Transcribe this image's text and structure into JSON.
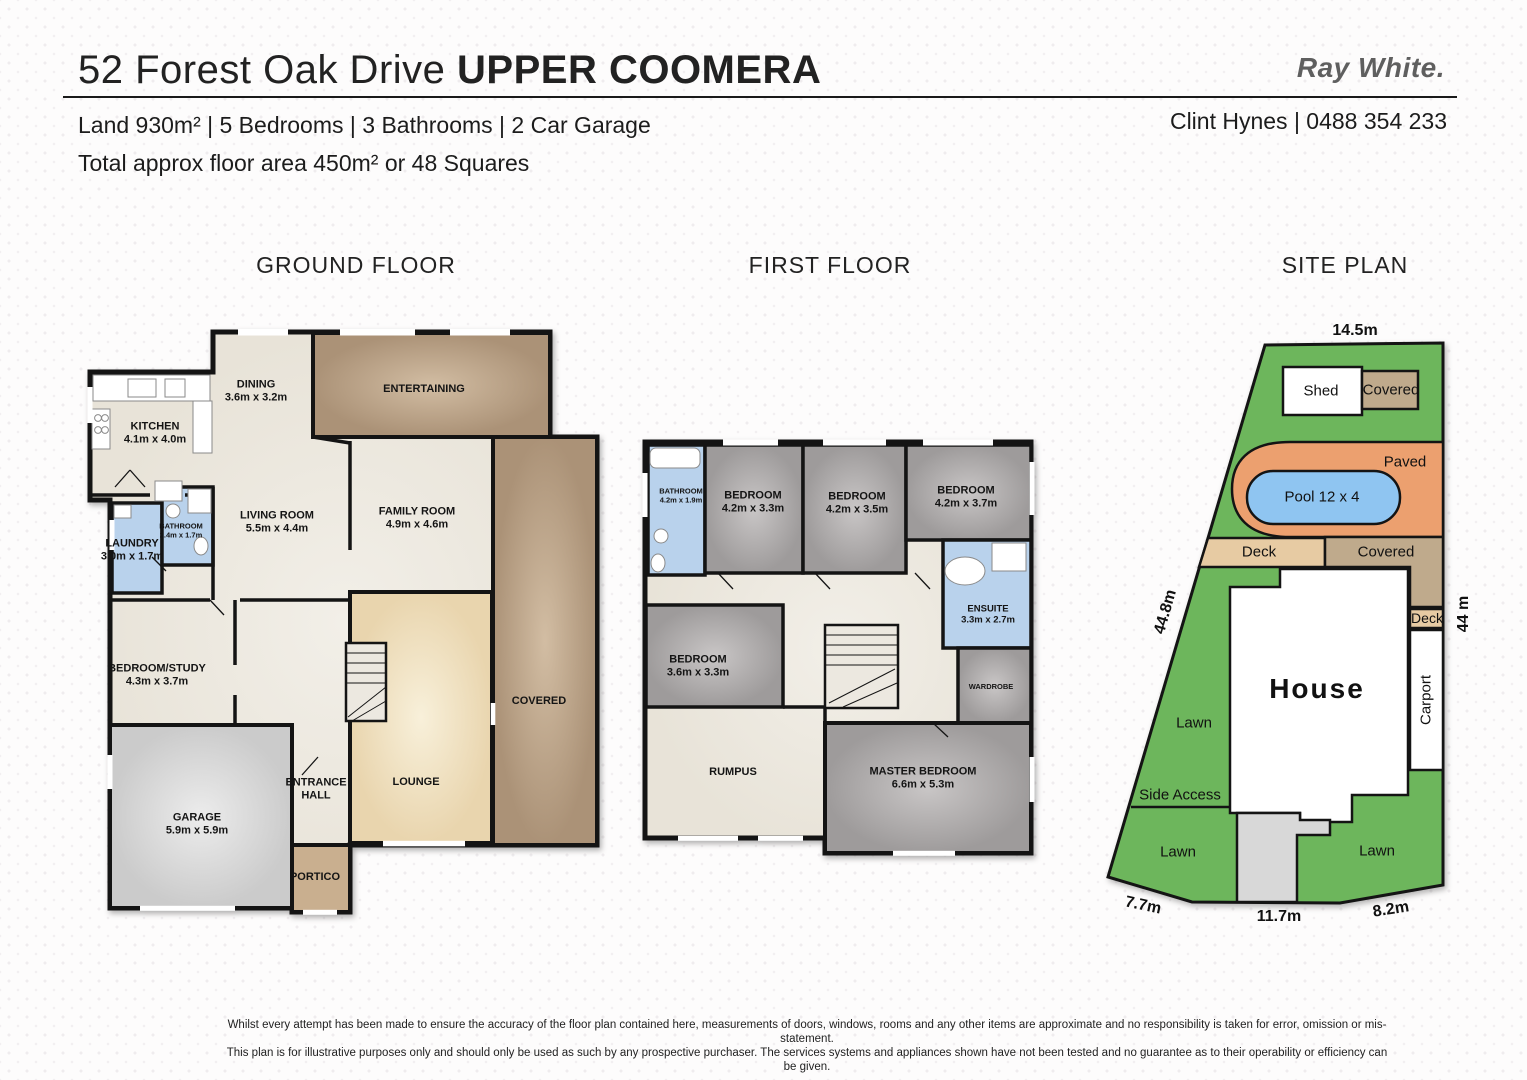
{
  "header": {
    "address": "52 Forest Oak Drive",
    "suburb": "UPPER COOMERA",
    "brand": "Ray White.",
    "agent": "Clint Hynes | 0488 354 233",
    "land_line": "Land 930m² | 5 Bedrooms | 3 Bathrooms | 2 Car Garage",
    "area_line": "Total approx floor area 450m² or 48 Squares"
  },
  "sections": {
    "ground": "GROUND FLOOR",
    "first": "FIRST FLOOR",
    "site": "SITE PLAN"
  },
  "ground_floor": {
    "rooms": {
      "kitchen": {
        "name": "KITCHEN",
        "dims": "4.1m x 4.0m"
      },
      "dining": {
        "name": "DINING",
        "dims": "3.6m x 3.2m"
      },
      "entertaining": {
        "name": "ENTERTAINING",
        "dims": ""
      },
      "living": {
        "name": "LIVING ROOM",
        "dims": "5.5m x 4.4m"
      },
      "family": {
        "name": "FAMILY ROOM",
        "dims": "4.9m x 4.6m"
      },
      "bathroom": {
        "name": "BATHROOM",
        "dims": "2.4m x 1.7m"
      },
      "laundry": {
        "name": "LAUNDRY",
        "dims": "3.0m x 1.7m"
      },
      "bedroom_study": {
        "name": "BEDROOM/STUDY",
        "dims": "4.3m x 3.7m"
      },
      "entrance_hall": {
        "name": "ENTRANCE HALL",
        "dims": ""
      },
      "lounge": {
        "name": "LOUNGE",
        "dims": ""
      },
      "covered": {
        "name": "COVERED",
        "dims": ""
      },
      "garage": {
        "name": "GARAGE",
        "dims": "5.9m x 5.9m"
      },
      "portico": {
        "name": "PORTICO",
        "dims": ""
      }
    }
  },
  "first_floor": {
    "rooms": {
      "bathroom": {
        "name": "BATHROOM",
        "dims": "4.2m x 1.9m"
      },
      "bedroom_1": {
        "name": "BEDROOM",
        "dims": "4.2m x 3.3m"
      },
      "bedroom_2": {
        "name": "BEDROOM",
        "dims": "4.2m x 3.5m"
      },
      "bedroom_3": {
        "name": "BEDROOM",
        "dims": "4.2m x 3.7m"
      },
      "bedroom_4": {
        "name": "BEDROOM",
        "dims": "3.6m x 3.3m"
      },
      "ensuite": {
        "name": "ENSUITE",
        "dims": "3.3m x 2.7m"
      },
      "wardrobe": {
        "name": "WARDROBE",
        "dims": ""
      },
      "rumpus": {
        "name": "RUMPUS",
        "dims": ""
      },
      "master_bedroom": {
        "name": "MASTER BEDROOM",
        "dims": "6.6m x 5.3m"
      }
    }
  },
  "site_plan": {
    "labels": {
      "shed": "Shed",
      "covered_top": "Covered",
      "paved": "Paved",
      "pool": "Pool 12 x 4",
      "deck": "Deck",
      "covered_mid": "Covered",
      "deck_small": "Deck",
      "carport": "Carport",
      "house": "House",
      "lawn_left": "Lawn",
      "side_access": "Side Access",
      "lawn_bottom_left": "Lawn",
      "lawn_bottom_right": "Lawn"
    },
    "dimensions": {
      "top": "14.5m",
      "left": "44.8m",
      "right": "44 m",
      "bottom_left": "7.7m",
      "bottom_center": "11.7m",
      "bottom_right": "8.2m"
    }
  },
  "disclaimer": {
    "line1": "Whilst every attempt has been made to ensure the accuracy of the floor plan contained here, measurements of doors, windows, rooms and any other items are approximate and no responsibility is taken for error, omission or mis-statement.",
    "line2": "This plan is for illustrative purposes only and should only be used as such by any prospective purchaser. The services systems and appliances shown have not been tested and no guarantee as to their operability or efficiency can be given."
  },
  "colors": {
    "wall": "#141414",
    "floor_cream": "#ece8e0",
    "wet_area_blue": "#b9d2ec",
    "covered_brown": "#b49b80",
    "timber_tan": "#eeddb9",
    "garage_gray": "#d6d6d6",
    "bedroom_gray": "#a9a6a6",
    "lawn_green": "#6db65c",
    "paved_orange": "#eca06f",
    "pool_blue": "#8fc5f1",
    "deck_tan": "#e7cba3",
    "site_covered_tan": "#bfaa8c",
    "driveway_gray": "#d8d8d8",
    "brand_gray": "#5f5f5f"
  }
}
